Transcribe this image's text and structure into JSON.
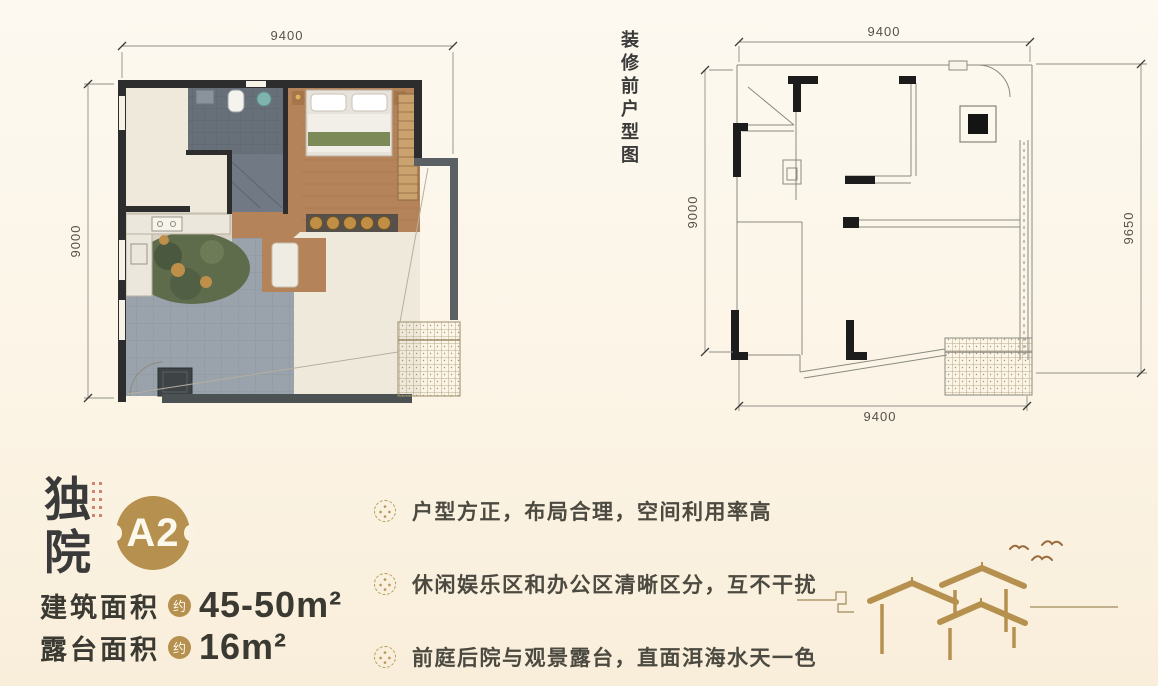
{
  "colors": {
    "accent_gold": "#b6904e",
    "ink": "#3a3a3a",
    "wall_dark": "#2d2d2d",
    "terrace_gray": "#9aa3ac",
    "wood": "#b5835a",
    "seal_red": "#c2604a"
  },
  "left_plan": {
    "dim_top": "9400",
    "dim_left": "9000"
  },
  "right_plan": {
    "caption": "装修前户型图",
    "dim_top": "9400",
    "dim_left": "9000",
    "dim_right": "9650",
    "dim_bottom": "9400"
  },
  "unit": {
    "type_chars": [
      "独",
      "院"
    ],
    "badge": "A2"
  },
  "areas": [
    {
      "label": "建筑面积",
      "approx": "约",
      "value": "45-50m²"
    },
    {
      "label": "露台面积",
      "approx": "约",
      "value": "16m²"
    }
  ],
  "features": [
    "户型方正，布局合理，空间利用率高",
    "休闲娱乐区和办公区清晰区分，互不干扰",
    "前庭后院与观景露台，直面洱海水天一色"
  ]
}
